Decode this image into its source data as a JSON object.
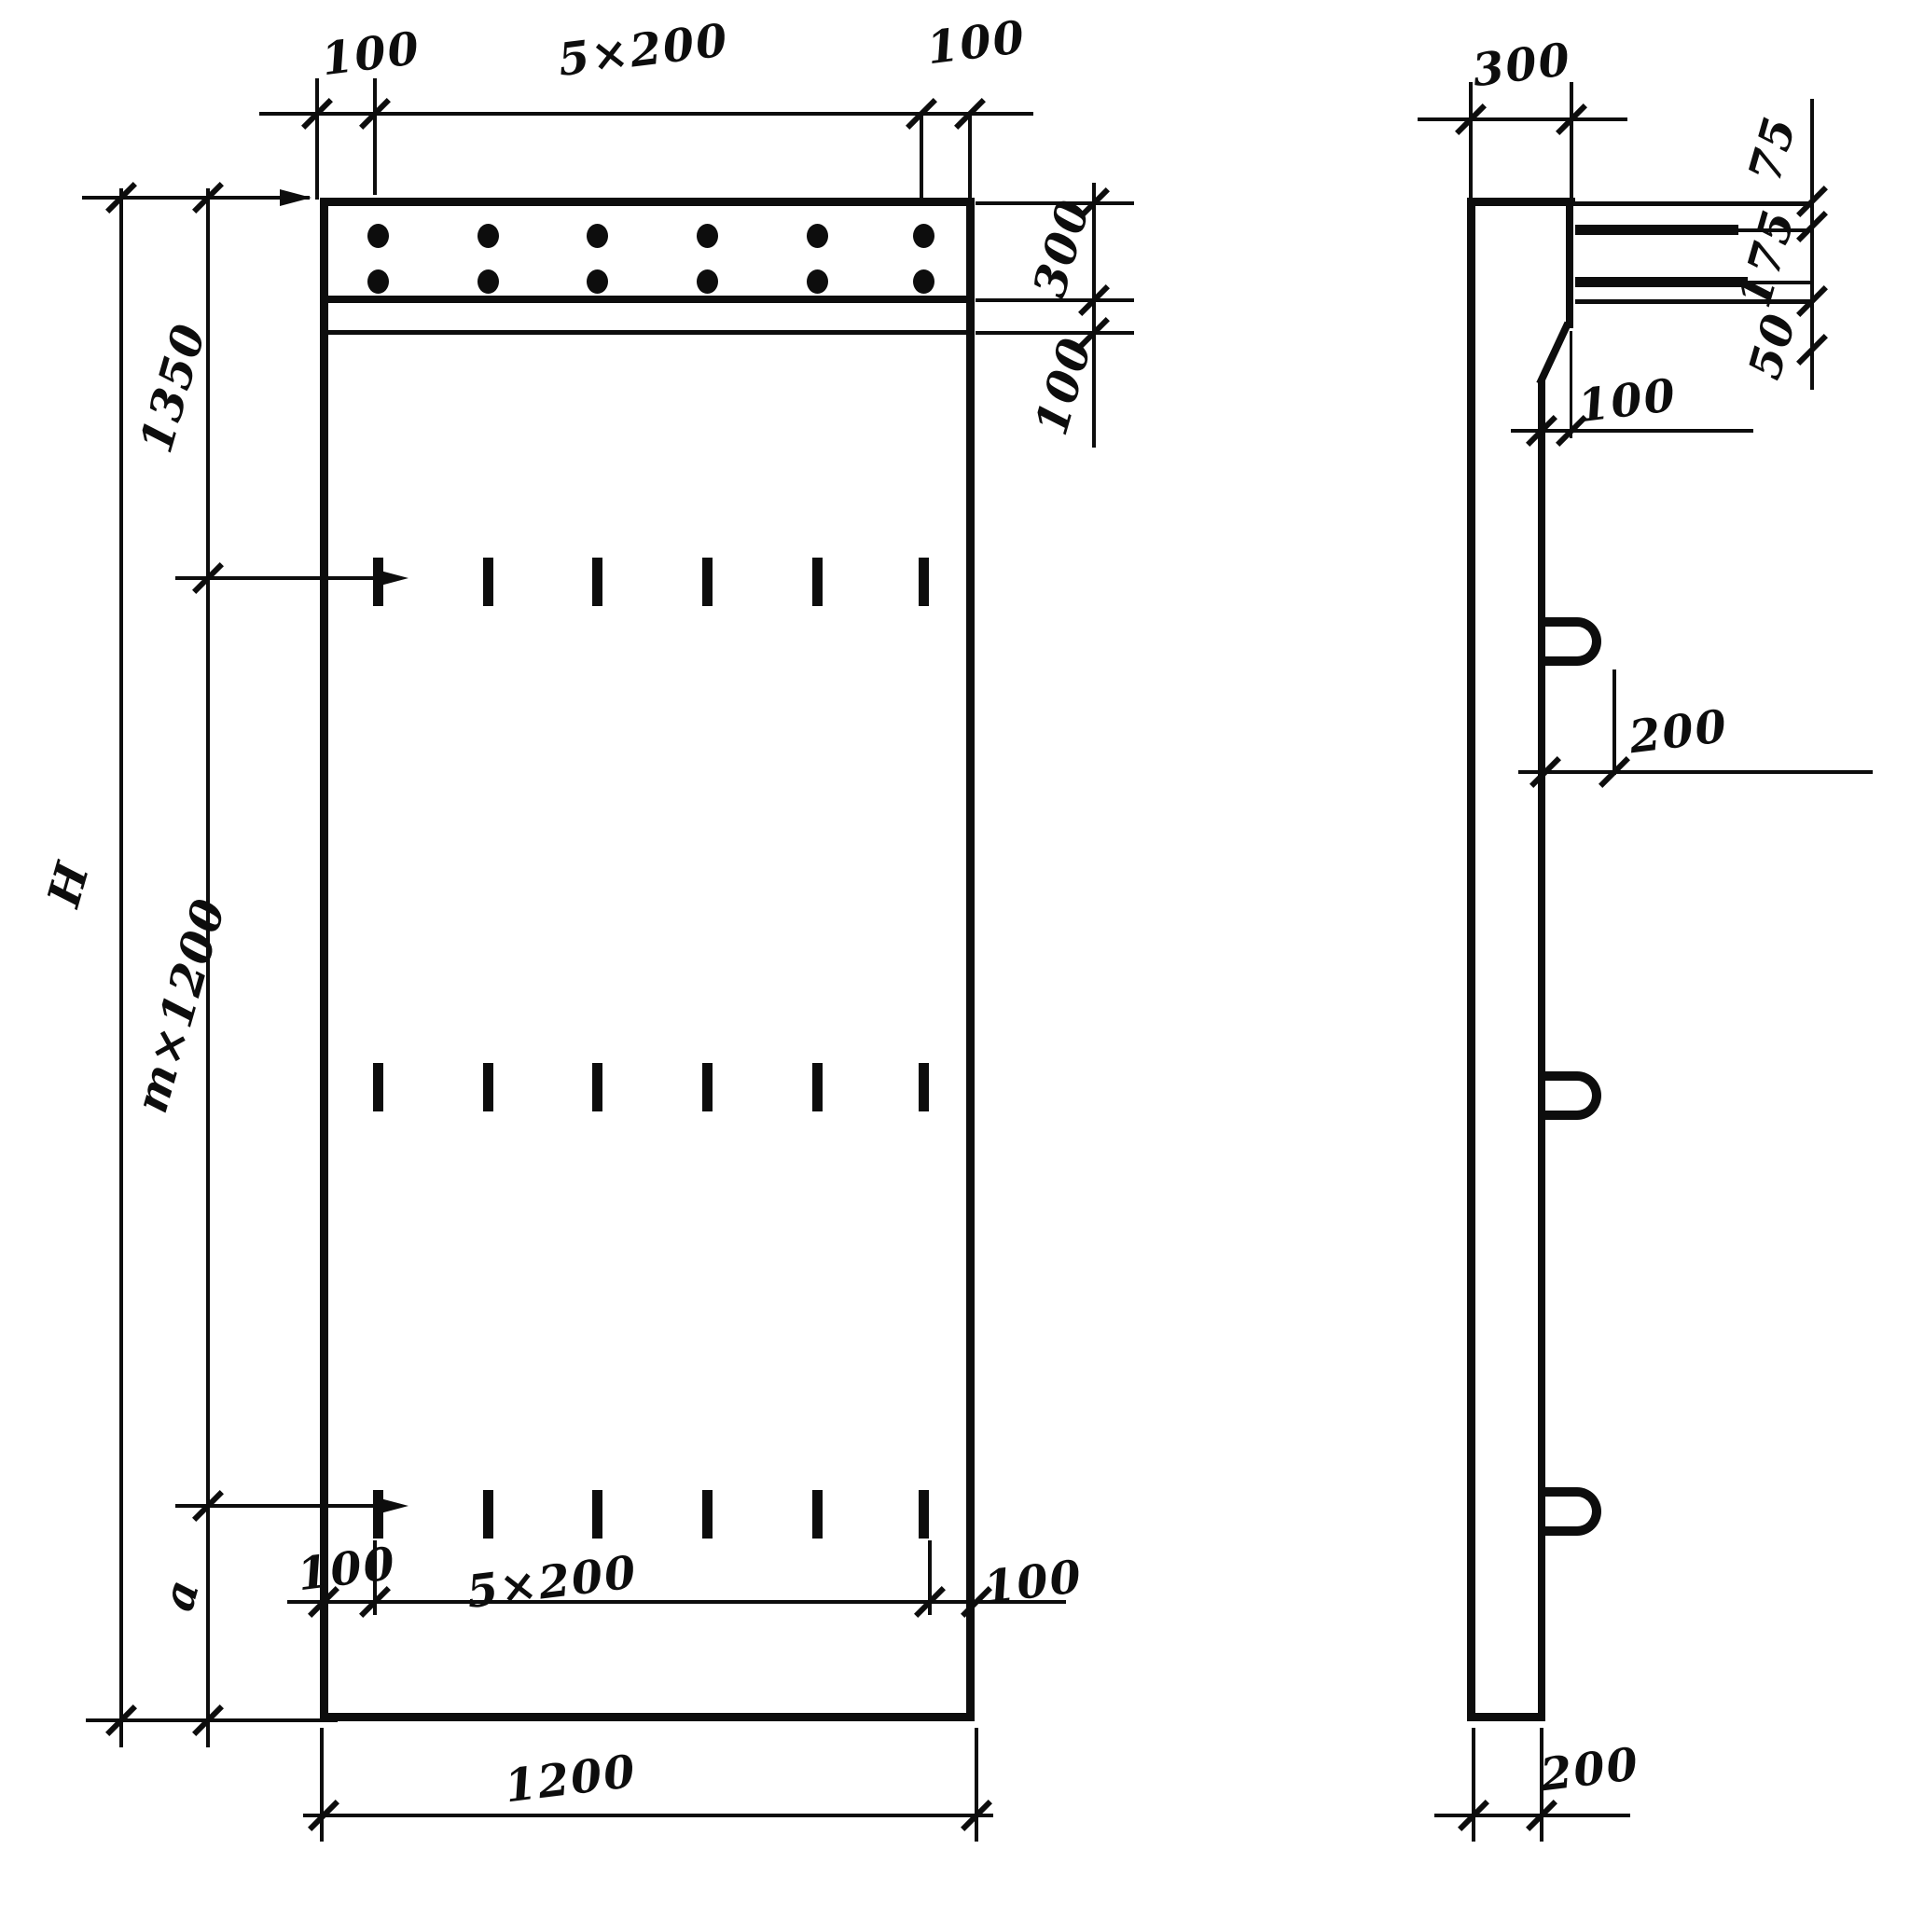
{
  "front": {
    "top": {
      "left_margin": "100",
      "spacing": "5×200",
      "right_margin": "100"
    },
    "right": {
      "band_height": "300",
      "strip_height": "100"
    },
    "left": {
      "total_height": "H",
      "top_segment": "1350",
      "middle_segment": "m×1200",
      "bottom_segment": "a"
    },
    "bottom": {
      "left_margin": "100",
      "spacing": "5×200",
      "right_margin": "100",
      "panel_width": "1200"
    }
  },
  "side": {
    "top_thickness": "300",
    "bars": {
      "top_offset": "75",
      "middle_gap": "175",
      "bottom_gap": "50"
    },
    "chamfer_offset": "100",
    "loop_projection": "200",
    "stem_thickness": "200"
  }
}
